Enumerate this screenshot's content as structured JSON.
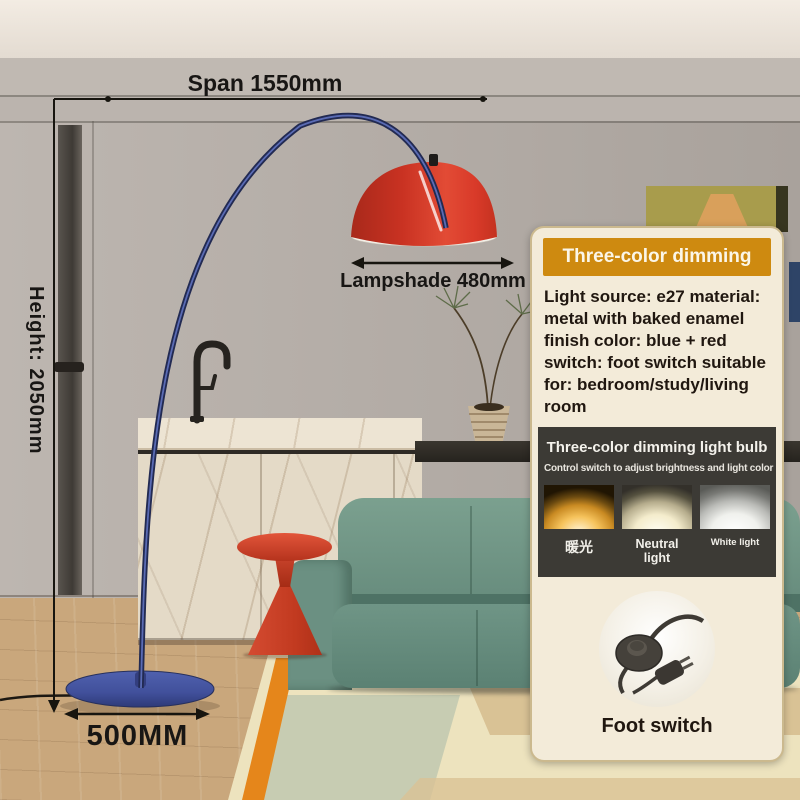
{
  "annotations": {
    "span": "Span 1550mm",
    "height": "Height: 2050mm",
    "lampshade": "Lampshade 480mm",
    "base_diameter": "500MM"
  },
  "info_panel": {
    "header": "Three-color dimming",
    "specs": "Light source: e27 material: metal with baked enamel finish color: blue + red switch: foot switch suitable for: bedroom/study/living room",
    "bulb": {
      "title": "Three-color dimming light bulb",
      "subtitle": "Control switch to adjust brightness and light color",
      "modes": [
        {
          "label": "暖光",
          "glow_color": "#F6C35C"
        },
        {
          "label": "Neutral light",
          "glow_color": "#F4ECCC"
        },
        {
          "label": "White light",
          "glow_color": "#F0F1ED"
        }
      ]
    },
    "foot_switch_label": "Foot switch"
  },
  "colors": {
    "header_orange": "#CE8A10",
    "panel_cream": "#F3EBD9",
    "section_dark": "#3C3A35",
    "lampshade_red": "#D63A2B",
    "lamp_blue": "#3D4E9E",
    "sofa_green": "#6B9082",
    "side_table_red": "#C9402A"
  }
}
